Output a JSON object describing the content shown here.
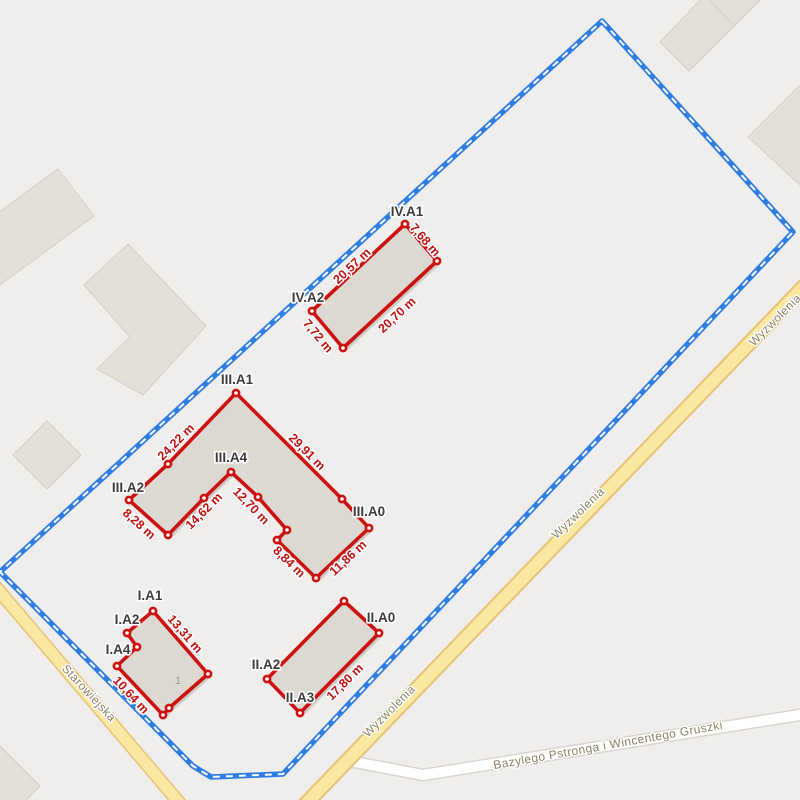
{
  "map": {
    "canvas": {
      "width": 800,
      "height": 800,
      "background": "#efeeec"
    },
    "palette": {
      "building_fill": "#e3e0da",
      "building_stroke": "#d2cfc8",
      "parcel_fill": "#dcd8d2",
      "parcel_fill_stroke": "#cfccc5",
      "boundary_blue": "#2e7de2",
      "boundary_dash_white": "#ffffff",
      "parcel_red": "#cc1111",
      "measure_red": "#c11212",
      "vertex_label_color": "#3c3c3c",
      "vertex_fill": "#ffffff",
      "road_fill": "#fbe8a2",
      "road_casing": "#e6c274",
      "minor_road_fill": "#ffffff",
      "minor_road_casing": "#d8d5cf",
      "road_label_color": "#8b8166",
      "house_number_color": "#9f9a93",
      "halo": "#ffffff",
      "shadow": "#b9b5ae"
    },
    "background_buildings": [
      {
        "points": [
          [
            58,
            169
          ],
          [
            94,
            216
          ],
          [
            -40,
            314
          ],
          [
            -76,
            267
          ]
        ]
      },
      {
        "points": [
          [
            128,
            244
          ],
          [
            206,
            326
          ],
          [
            143,
            395
          ],
          [
            97,
            369
          ],
          [
            130,
            337
          ],
          [
            84,
            285
          ]
        ]
      },
      {
        "points": [
          [
            47,
            421
          ],
          [
            81,
            455
          ],
          [
            47,
            489
          ],
          [
            13,
            455
          ]
        ]
      },
      {
        "points": [
          [
            660,
            42
          ],
          [
            706,
            -6
          ],
          [
            770,
            -10
          ],
          [
            689,
            71
          ]
        ]
      },
      {
        "points": [
          [
            748,
            137
          ],
          [
            800,
            85
          ],
          [
            852,
            137
          ],
          [
            800,
            185
          ]
        ]
      },
      {
        "points": [
          [
            -2,
            744
          ],
          [
            40,
            786
          ],
          [
            -2,
            828
          ]
        ]
      }
    ],
    "background_building_lines": [
      {
        "points": [
          [
            710,
            0
          ],
          [
            732,
            24
          ]
        ]
      }
    ],
    "boundary": {
      "points": [
        [
          602,
          21
        ],
        [
          793,
          232
        ],
        [
          283,
          774
        ],
        [
          211,
          777
        ],
        [
          193,
          766
        ],
        [
          0,
          572
        ]
      ],
      "line_width": 5.5,
      "dash_width": 2,
      "dash_pattern": "7 6"
    },
    "roads": [
      {
        "name": "Bazylego Pstronga i Wincentego Gruszki",
        "type": "minor",
        "width": 10,
        "casing": 13,
        "path": [
          [
            344,
            760
          ],
          [
            423,
            775
          ],
          [
            812,
            713
          ]
        ]
      },
      {
        "name": "Starowiejska",
        "type": "major",
        "width": 11,
        "casing": 14,
        "path": [
          [
            -6,
            585
          ],
          [
            194,
            820
          ]
        ]
      },
      {
        "name": "Wyzwolenia",
        "type": "major",
        "width": 12,
        "casing": 16,
        "path": [
          [
            814,
            276
          ],
          [
            296,
            814
          ]
        ]
      }
    ],
    "road_labels": [
      {
        "text": "Wyzwolenia",
        "x": 775,
        "y": 320,
        "rotate": -45
      },
      {
        "text": "Wyzwolenia",
        "x": 578,
        "y": 513,
        "rotate": -44
      },
      {
        "text": "Wyzwolenia",
        "x": 389,
        "y": 711,
        "rotate": -45
      },
      {
        "text": "Starowiejska",
        "x": 89,
        "y": 693,
        "rotate": 47
      },
      {
        "text": "Bazylego Pstronga i Wincentego Gruszki",
        "x": 608,
        "y": 745,
        "rotate": -10
      }
    ],
    "parcels": [
      {
        "id": "IV",
        "points": [
          [
            405,
            224
          ],
          [
            437,
            261
          ],
          [
            343,
            348
          ],
          [
            312,
            311
          ]
        ],
        "vertex_labels": [
          {
            "text": "IV.A1",
            "x": 407,
            "y": 216
          },
          {
            "text": "IV.A2",
            "x": 308,
            "y": 302
          }
        ],
        "measurements": [
          {
            "text": "7,68 m",
            "x": 425,
            "y": 240,
            "rotate": 49
          },
          {
            "text": "20,70 m",
            "x": 397,
            "y": 315,
            "rotate": -43
          },
          {
            "text": "7,72 m",
            "x": 318,
            "y": 336,
            "rotate": 50
          },
          {
            "text": "20,57 m",
            "x": 352,
            "y": 266,
            "rotate": -43
          }
        ],
        "house_numbers": []
      },
      {
        "id": "III",
        "points": [
          [
            236,
            393
          ],
          [
            342,
            499
          ],
          [
            369,
            528
          ],
          [
            316,
            578
          ],
          [
            277,
            540
          ],
          [
            287,
            530
          ],
          [
            258,
            497
          ],
          [
            231,
            472
          ],
          [
            204,
            498
          ],
          [
            168,
            535
          ],
          [
            129,
            500
          ],
          [
            168,
            464
          ]
        ],
        "vertex_labels": [
          {
            "text": "III.A1",
            "x": 237,
            "y": 384
          },
          {
            "text": "III.A4",
            "x": 231,
            "y": 462
          },
          {
            "text": "III.A2",
            "x": 128,
            "y": 492
          },
          {
            "text": "III.A0",
            "x": 369,
            "y": 516
          }
        ],
        "measurements": [
          {
            "text": "29,91 m",
            "x": 307,
            "y": 452,
            "rotate": 45
          },
          {
            "text": "24,22 m",
            "x": 176,
            "y": 442,
            "rotate": -45
          },
          {
            "text": "8,28 m",
            "x": 139,
            "y": 524,
            "rotate": 42
          },
          {
            "text": "14,62 m",
            "x": 204,
            "y": 511,
            "rotate": -45
          },
          {
            "text": "12,70 m",
            "x": 251,
            "y": 506,
            "rotate": 46
          },
          {
            "text": "8,84 m",
            "x": 289,
            "y": 562,
            "rotate": 44
          },
          {
            "text": "11,86 m",
            "x": 348,
            "y": 558,
            "rotate": -43
          }
        ],
        "house_numbers": []
      },
      {
        "id": "I",
        "points": [
          [
            153,
            611
          ],
          [
            208,
            674
          ],
          [
            169,
            708
          ],
          [
            163,
            715
          ],
          [
            117,
            666
          ],
          [
            137,
            647
          ],
          [
            127,
            633
          ]
        ],
        "vertex_labels": [
          {
            "text": "I.A1",
            "x": 150,
            "y": 600
          },
          {
            "text": "I.A2",
            "x": 127,
            "y": 624
          },
          {
            "text": "I.A4",
            "x": 118,
            "y": 654
          }
        ],
        "measurements": [
          {
            "text": "13,31 m",
            "x": 185,
            "y": 634,
            "rotate": 49
          },
          {
            "text": "10,64 m",
            "x": 131,
            "y": 695,
            "rotate": 47
          }
        ],
        "house_numbers": [
          {
            "text": "1",
            "x": 178,
            "y": 684
          }
        ]
      },
      {
        "id": "II",
        "points": [
          [
            344,
            601
          ],
          [
            379,
            633
          ],
          [
            300,
            713
          ],
          [
            267,
            679
          ]
        ],
        "vertex_labels": [
          {
            "text": "II.A0",
            "x": 381,
            "y": 622
          },
          {
            "text": "II.A2",
            "x": 266,
            "y": 669
          },
          {
            "text": "II.A3",
            "x": 300,
            "y": 702
          }
        ],
        "measurements": [
          {
            "text": "17,80 m",
            "x": 345,
            "y": 682,
            "rotate": -45
          }
        ],
        "house_numbers": []
      }
    ]
  }
}
